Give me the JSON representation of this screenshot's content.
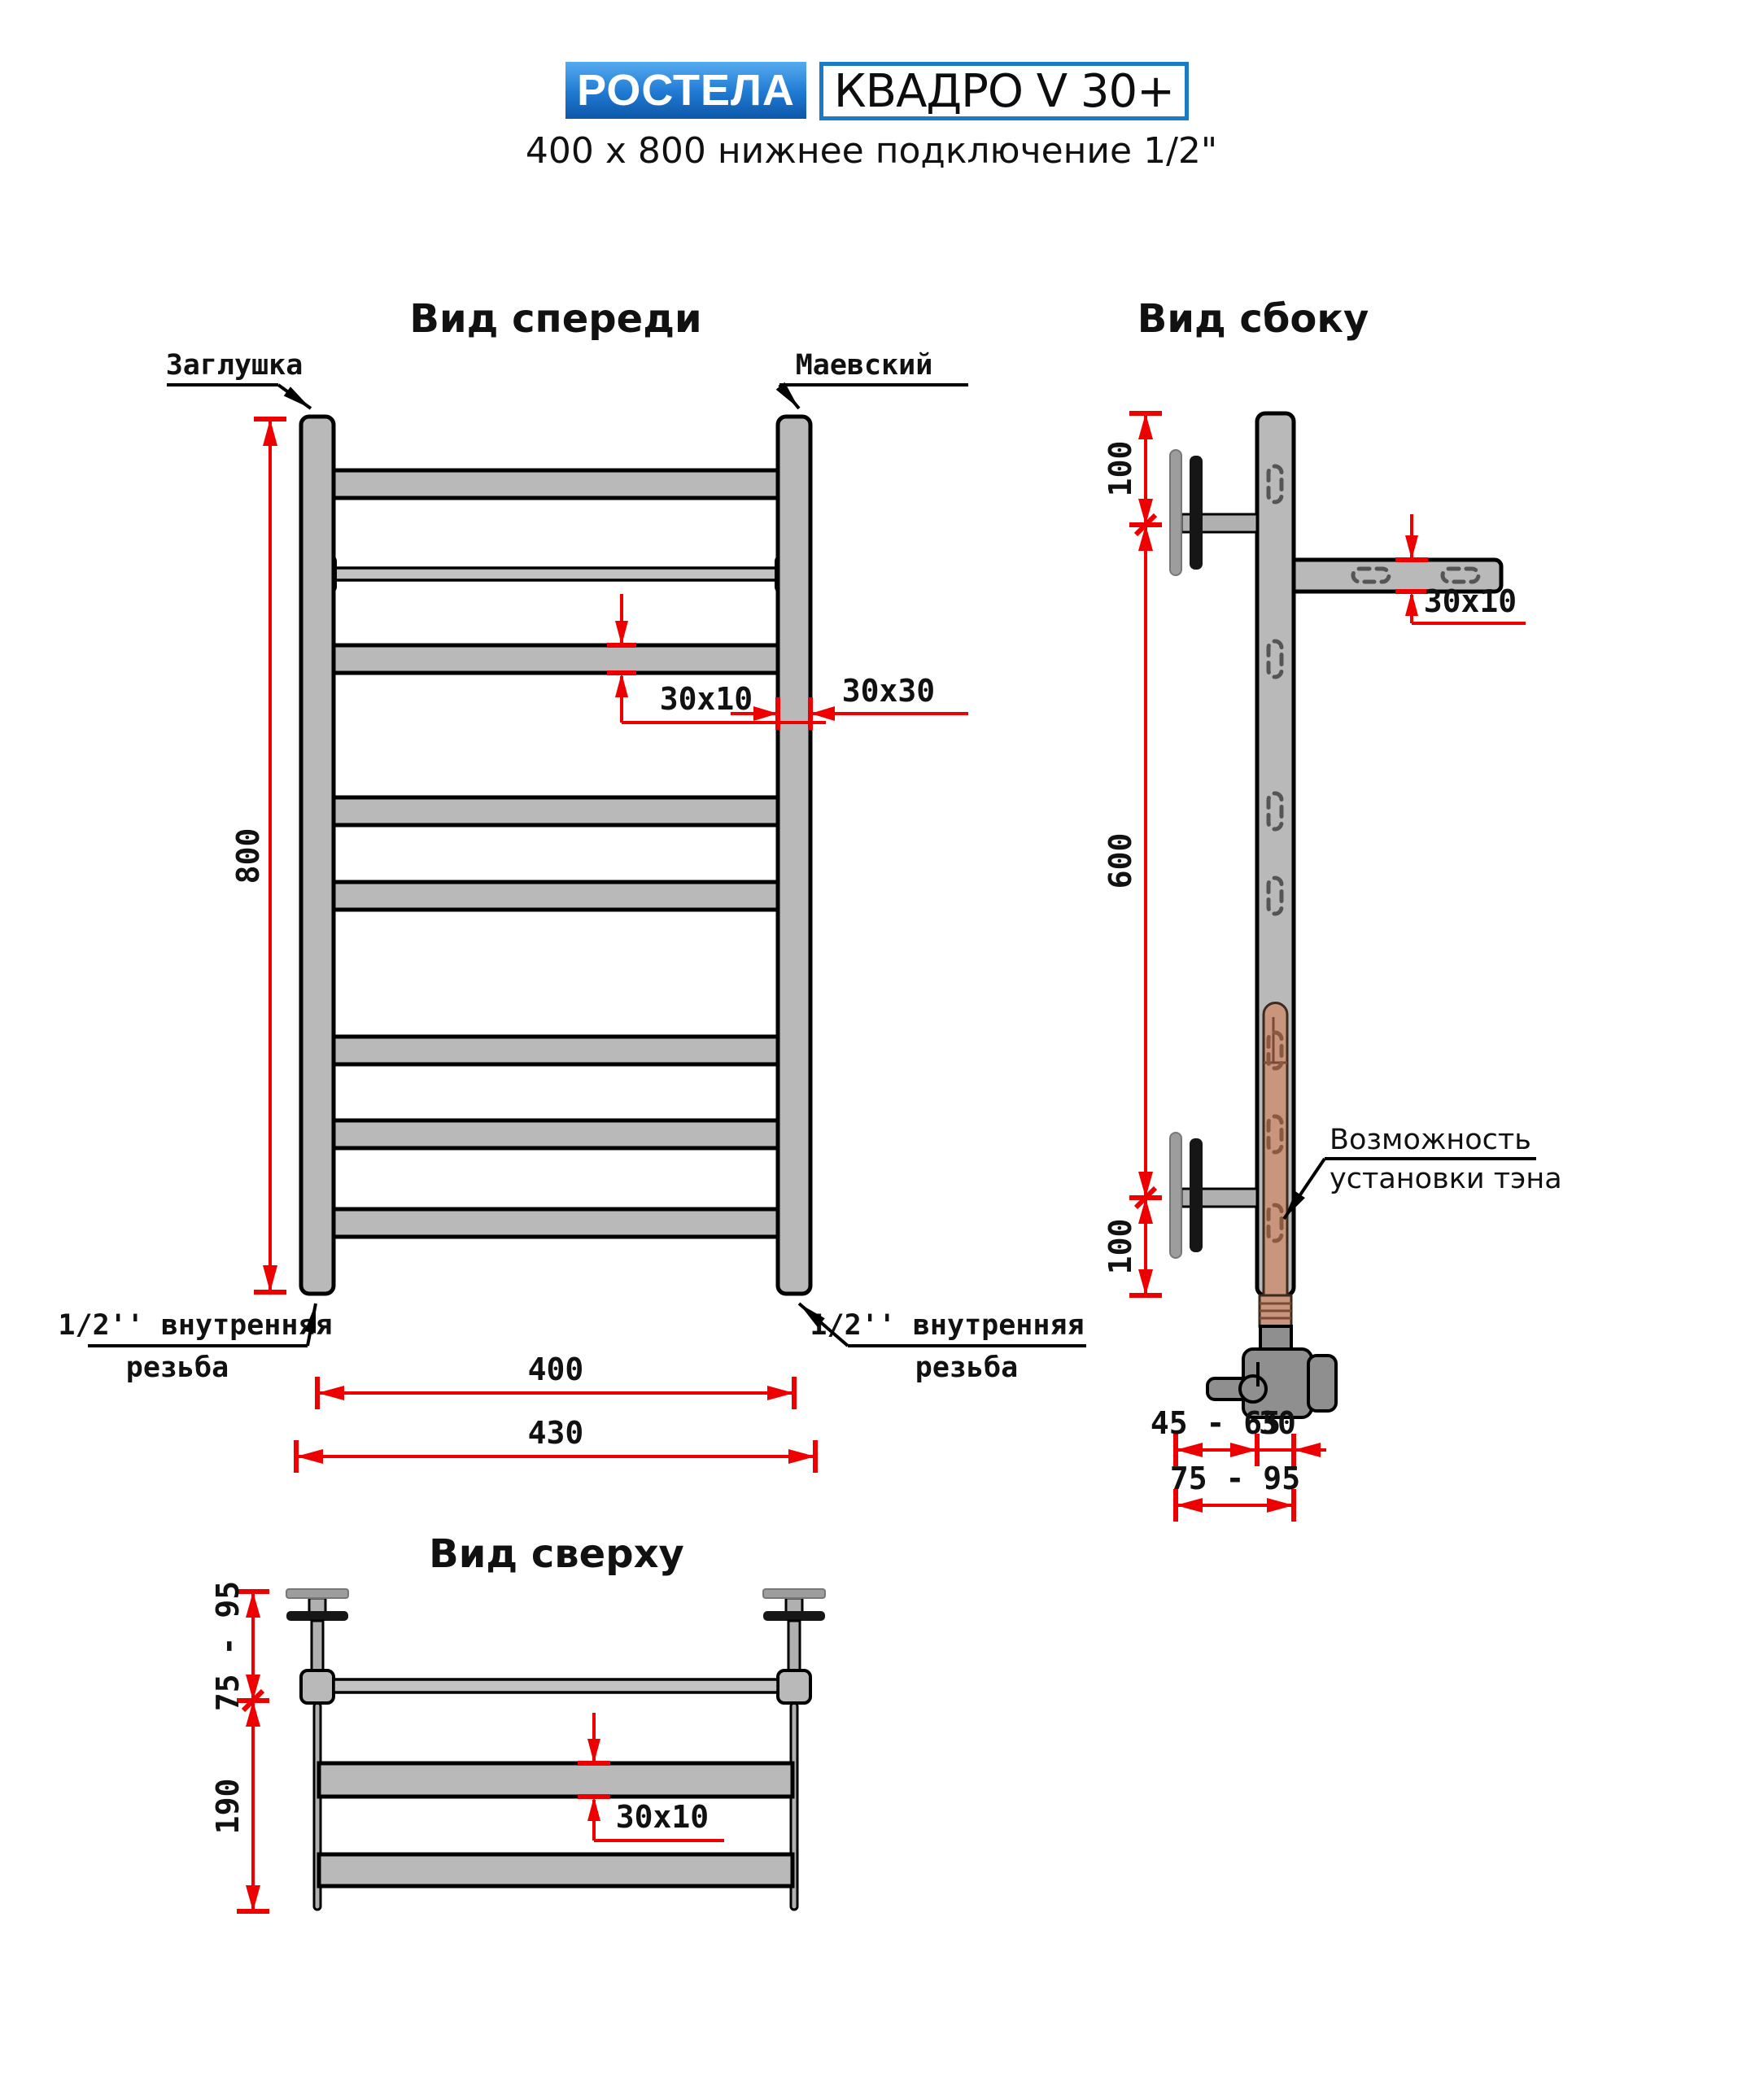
{
  "header": {
    "brand": "РОСТЕЛА",
    "model": "КВАДРО V 30+",
    "subtitle": "400 x 800 нижнее подключение 1/2\""
  },
  "colors": {
    "accent_red": "#ee0000",
    "metal_gray": "#b9b9b9",
    "light_gray": "#9d9d9d",
    "heater_tan": "#c9957c",
    "logo_blue_top": "#55abef",
    "logo_blue_bottom": "#0d57a8",
    "model_border_blue": "#1a7ac6"
  },
  "front_view": {
    "title": "Вид спереди",
    "label_cap": "Заглушка",
    "label_valve": "Маевский",
    "thread_left_line1": "1/2'' внутренняя",
    "thread_left_line2": "резьба",
    "thread_right_line1": "1/2'' внутренняя",
    "thread_right_line2": "резьба",
    "dim_height": "800",
    "dim_tube": "30x10",
    "dim_post": "30x30",
    "dim_width_axes": "400",
    "dim_width_outer": "430"
  },
  "side_view": {
    "title": "Вид сбоку",
    "dim_top": "100",
    "dim_mid": "600",
    "dim_bottom": "100",
    "dim_tube": "30x10",
    "note_line1": "Возможность",
    "note_line2": "установки тэна",
    "dim_wall_gap": "45 - 65",
    "dim_post_depth": "30",
    "dim_total_depth": "75 - 95"
  },
  "top_view": {
    "title": "Вид сверху",
    "dim_bracket_depth": "75 - 95",
    "dim_total": "190",
    "dim_tube": "30x10"
  }
}
